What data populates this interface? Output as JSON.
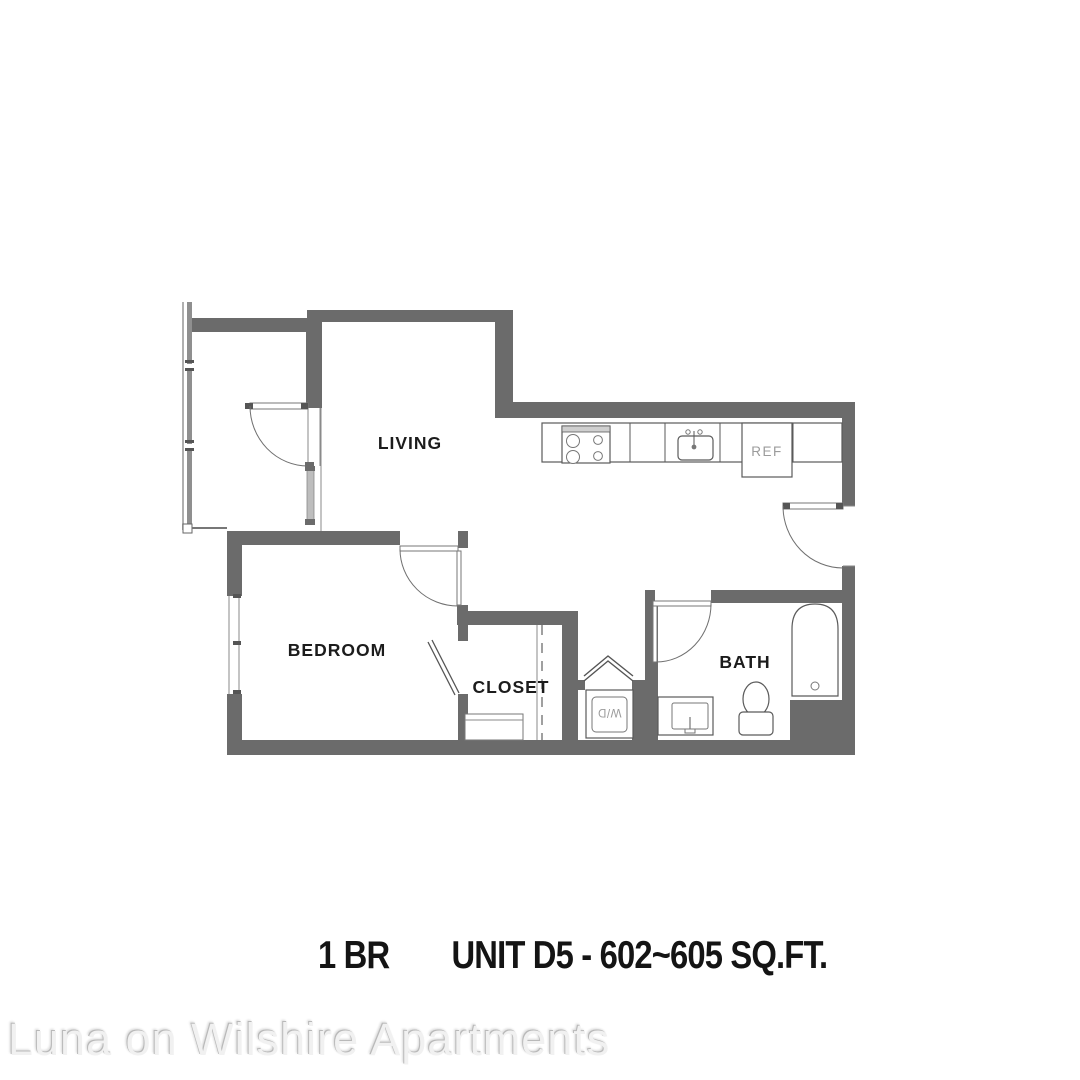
{
  "floor_plan": {
    "rooms": {
      "living": "LIVING",
      "bedroom": "BEDROOM",
      "closet": "CLOSET",
      "bath": "BATH"
    },
    "appliances": {
      "refrigerator": "REF",
      "washer_dryer": "W/D"
    },
    "colors": {
      "wall": "#6b6b6b",
      "fixture_line": "#5a5a5a",
      "room_label": "#1c1c1c",
      "appliance_label": "#9b9b9b"
    }
  },
  "title": {
    "bedroom_count": "1 BR",
    "unit_info": "UNIT D5 - 602~605 SQ.FT."
  },
  "watermark": {
    "text": "Luna on Wilshire Apartments"
  }
}
